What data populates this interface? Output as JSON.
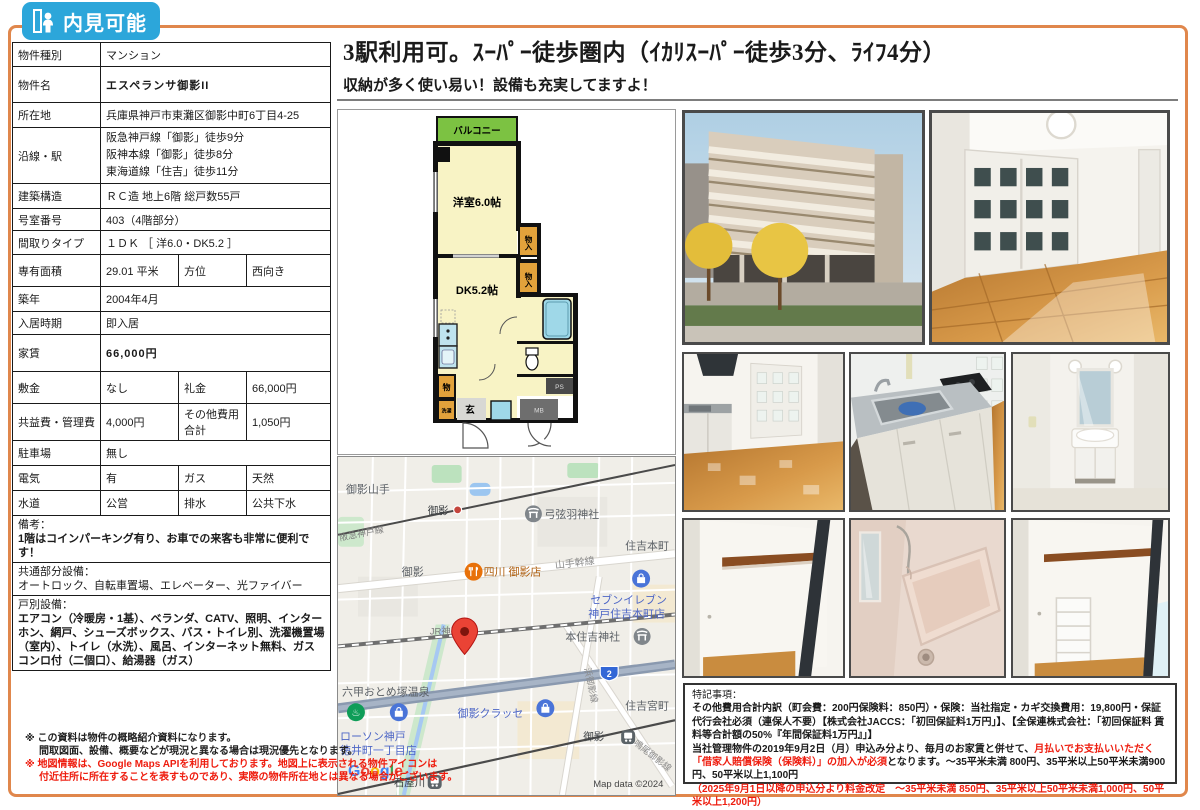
{
  "badge": {
    "label": "内見可能"
  },
  "header": {
    "title": "3駅利用可。ｽｰﾊﾟｰ徒歩圏内（ｲｶﾘｽｰﾊﾟｰ徒歩3分、ﾗｲﾌ4分）",
    "subtitle": "収納が多く使い易い！設備も充実してますよ！"
  },
  "property": {
    "type_label": "物件種別",
    "type": "マンション",
    "name_label": "物件名",
    "name": "エスペランサ御影II",
    "address_label": "所在地",
    "address": "兵庫県神戸市東灘区御影中町6丁目4-25",
    "lines_label": "沿線・駅",
    "lines": [
      "阪急神戸線「御影」徒歩9分",
      "阪神本線「御影」徒歩8分",
      "東海道線「住吉」徒歩11分"
    ],
    "structure_label": "建築構造",
    "structure": "ＲＣ造 地上6階 総戸数55戸",
    "room_label": "号室番号",
    "room": "403（4階部分）",
    "layout_label": "間取りタイプ",
    "layout": "１ＤＫ ［ 洋6.0・DK5.2 ］",
    "area_label": "専有面積",
    "area": "29.01 平米",
    "direction_label": "方位",
    "direction": "西向き",
    "built_label": "築年",
    "built": "2004年4月",
    "movein_label": "入居時期",
    "movein": "即入居",
    "rent_label": "家賃",
    "rent": "66,000円",
    "deposit_label": "敷金",
    "deposit": "なし",
    "key_money_label": "礼金",
    "key_money": "66,000円",
    "fee_label": "共益費・管理費",
    "fee": "4,000円",
    "other_fee_label": "その他費用合計",
    "other_fee": "1,050円",
    "parking_label": "駐車場",
    "parking": "無し",
    "electric_label": "電気",
    "electric": "有",
    "gas_label": "ガス",
    "gas": "天然",
    "water_label": "水道",
    "water": "公営",
    "drain_label": "排水",
    "drain": "公共下水",
    "remarks_label": "備考：",
    "remarks": "1階はコインパーキング有り、お車での来客も非常に便利です！",
    "common_label": "共通部分設備：",
    "common": "オートロック、自転車置場、エレベーター、光ファイバー",
    "unit_label": "戸別設備：",
    "unit": "エアコン（冷暖房・1基）、ベランダ、CATV、照明、インターホン、網戸、シューズボックス、バス・トイレ別、洗濯機置場（室内）、トイレ（水洗）、風呂、インターネット無料、ガスコンロ付（二個口）、給湯器（ガス）"
  },
  "floorplan": {
    "balcony": "バルコニー",
    "room": "洋室6.0帖",
    "dk": "DK5.2帖",
    "closet1": "物入",
    "closet2": "物入",
    "storage": "物",
    "laundry": "洗濯",
    "entrance": "玄",
    "ps": "PS",
    "mb": "MB"
  },
  "map": {
    "labels": {
      "mikage_yamate": "御影山手",
      "hankyu_line": "阪急神戸線",
      "mikage_hankyu": "御影",
      "yuzuruha": "弓弦羽神社",
      "sumiyoshi_honmachi": "住吉本町",
      "mikage_area": "御影",
      "shisen": "四川 御影店",
      "yamate_kansen": "山手幹線",
      "seven_l1": "セブンイレブン",
      "seven_l2": "神戸住吉本町店",
      "jr_line": "JR神戸線",
      "moto_sumiyoshi": "本住吉神社",
      "rokko_onsen": "六甲おとめ塚温泉",
      "mikage_classe": "御影クラッセ",
      "lawson_l1": "ローソン神戸",
      "lawson_l2": "徳井町一丁目店",
      "sumiyoshi_miyamachi": "住吉宮町",
      "mikage_hanshin": "御影",
      "ishiyagawa": "石屋川",
      "naruo_mikage": "鳴尾御影線",
      "hama_mikage": "浜御影線"
    },
    "route_number": "2",
    "google_letters": [
      "G",
      "o",
      "o",
      "g",
      "l",
      "e"
    ],
    "attribution": "Map data ©2024"
  },
  "notes": {
    "heading": "特記事項：",
    "line1": "その他費用合計内訳（町会費：200円保険料：850円）・保険：当社指定・カギ交換費用：19,800円・保証代行会社必須（連保人不要）【株式会社JACCS：「初回保証料1万円」】、【全保連株式会社：「初回保証料 賃料等合計額の50%『年間保証料1万円』」】",
    "line2_black1": "当社管理物件の2019年9月2日（月）申込み分より、毎月のお家賃と併せて、",
    "line2_red": "月払いでお支払いいただく「借家人賠償保険（保険料）」の加入が必須",
    "line2_black2": "となります。～35平米未満 800円、35平米以上50平米未満900円、50平米以上1,100円",
    "line3_red": "（2025年9月1日以降の申込分より料金改定　～35平米未満 850円、35平米以上50平米未満1,000円、50平米以上1,200円）"
  },
  "disclaimer": {
    "line1": "※ この資料は物件の概略紹介資料になります。",
    "line2": "間取図面、設備、概要などが現況と異なる場合は現況優先となります。",
    "line3": "※ 地図情報は、Google Maps APIを利用しております。地図上に表示される物件アイコンは",
    "line4": "付近住所に所在することを表すものであり、実際の物件所在地とは異なる場合がございます。"
  },
  "colors": {
    "accent_orange": "#E0874C",
    "badge_blue": "#2CA6DA",
    "alert_red": "#EE1C0E",
    "map_pin_red": "#EA4335",
    "balcony_green": "#7CC242",
    "room_yellow": "#F8F3C5",
    "closet_orange": "#E2A23B",
    "tub_blue": "#9FD8E8"
  }
}
